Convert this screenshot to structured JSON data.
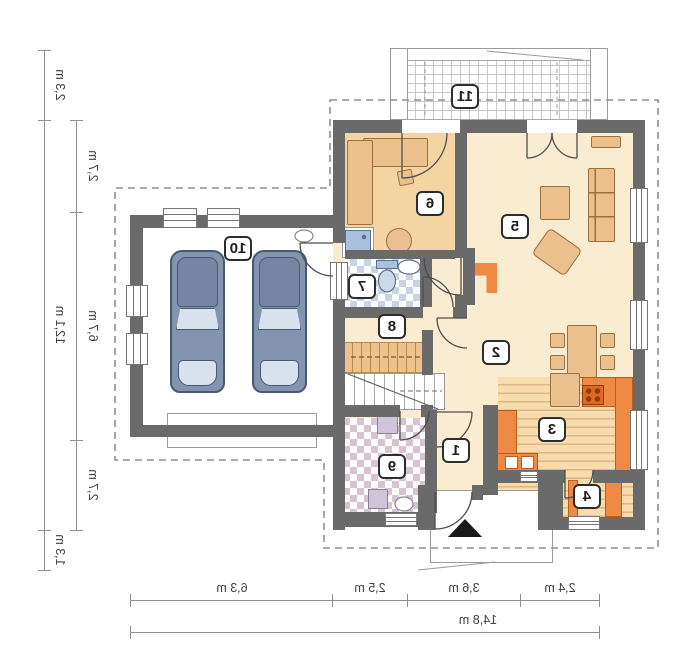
{
  "plan": {
    "type": "floor-plan-mirrored",
    "rooms": [
      {
        "number": "1"
      },
      {
        "number": "2"
      },
      {
        "number": "3"
      },
      {
        "number": "4"
      },
      {
        "number": "5"
      },
      {
        "number": "6"
      },
      {
        "number": "7"
      },
      {
        "number": "8"
      },
      {
        "number": "9"
      },
      {
        "number": "10"
      },
      {
        "number": "11"
      }
    ],
    "dimensions": {
      "left_outer": [
        "2,3 m",
        "12,1 m",
        "1,3 m"
      ],
      "left_inner": [
        "2,7 m",
        "6,7 m",
        "2,7 m"
      ],
      "bottom": [
        "6,3 m",
        "2,5 m",
        "3,6 m",
        "2,4 m"
      ],
      "bottom_total": "14,8 m"
    },
    "colors": {
      "wall": "#6a6a6a",
      "cream": "#faecd0",
      "tan": "#f3d4a2",
      "furn": "#ecc08c",
      "orange": "#ef8a45",
      "stove": "#e2671f",
      "blue": "#abc0de",
      "tilebath": "#c9d3e6",
      "tilelaundry": "#d8c4d0",
      "carbody": "#8294ae",
      "carglass": "#d9e1ec",
      "dim": "#8f8f8f"
    }
  }
}
